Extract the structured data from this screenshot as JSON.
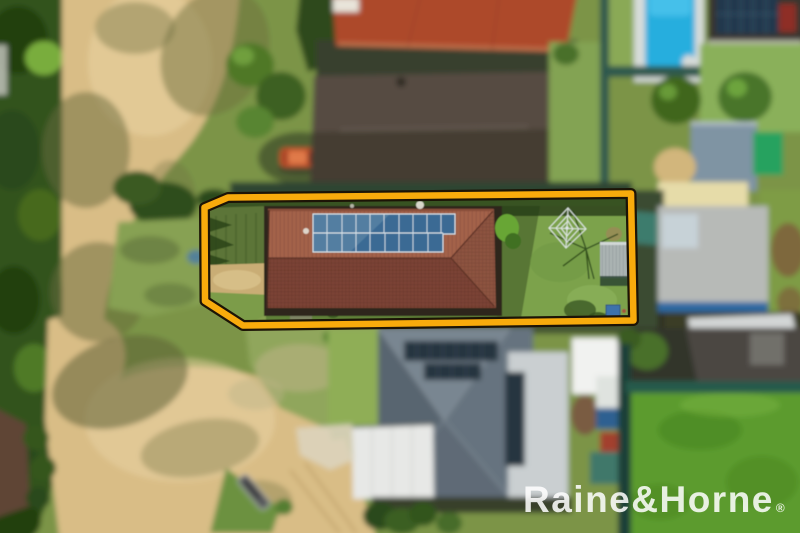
{
  "brand": {
    "watermark_text": "Raine&Horne",
    "registered_symbol": "®",
    "watermark_color": "#ffffff"
  },
  "annotation": {
    "label": "highlighted property boundary",
    "stroke_color": "#F8AB0C",
    "outline_color": "#1c1406"
  },
  "palette": {
    "base_green": "#7b9447",
    "sand": "#d9bd86",
    "sand_light": "#e9d4a3",
    "tree_dark": "#2f4d1c",
    "tree_mid": "#4e7428",
    "front_lawn": "#5b7437",
    "backyard_lawn": "#7ca24c",
    "neighbor_lawn": "#5c9b2e",
    "dirt_patch": "#c9ad74",
    "roof_terracotta_upper": "#a3624a",
    "roof_terracotta_lower": "#7b4334",
    "roof_red": "#ad4a2b",
    "roof_dark_brown": "#564c42",
    "roof_blue_gray": "#66737f",
    "roof_white": "#e7e8e6",
    "metal_roof_gray": "#b9bcb9",
    "pool_water": "#25aede",
    "solar_panel_blue": "#3a6b94",
    "solar_panel_dark": "#26343f",
    "fence_teal": "#2d584d",
    "tarp_green": "#27a25f"
  }
}
